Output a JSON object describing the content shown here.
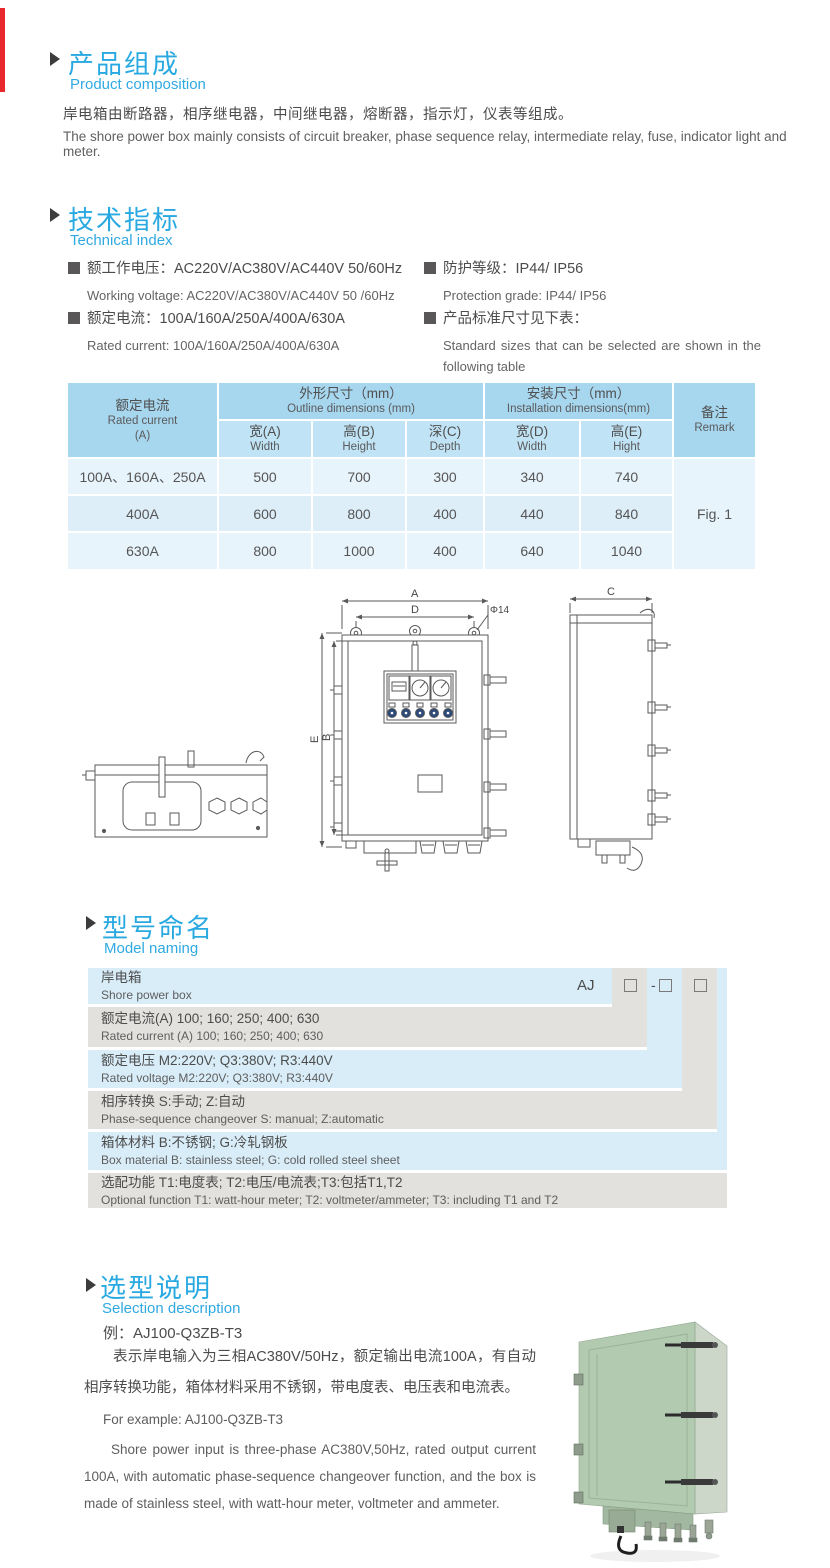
{
  "page": {
    "edge_tab_color": "#e8282d",
    "accent_blue": "#29a9e1"
  },
  "composition": {
    "title_zh": "产品组成",
    "title_en": "Product  composition",
    "body_zh": "岸电箱由断路器，相序继电器，中间继电器，熔断器，指示灯，仪表等组成。",
    "body_en": "The shore power box mainly consists of circuit breaker, phase sequence relay, intermediate relay, fuse, indicator light and meter."
  },
  "technical": {
    "title_zh": "技术指标",
    "title_en": "Technical index",
    "specs": [
      {
        "zh": "额工作电压：AC220V/AC380V/AC440V  50/60Hz",
        "en": "Working voltage: AC220V/AC380V/AC440V 50 /60Hz"
      },
      {
        "zh": "额定电流：100A/160A/250A/400A/630A",
        "en": "Rated current: 100A/160A/250A/400A/630A"
      },
      {
        "zh": "防护等级：IP44/ IP56",
        "en": "Protection grade: IP44/ IP56"
      },
      {
        "zh": "产品标准尺寸见下表：",
        "en": "Standard sizes that can be selected are shown in the following table"
      }
    ]
  },
  "size_table": {
    "rated_zh": "额定电流",
    "rated_en": "Rated current",
    "rated_unit": "(A)",
    "outline_zh": "外形尺寸（mm）",
    "outline_en": "Outline dimensions (mm)",
    "install_zh": "安装尺寸（mm）",
    "install_en": "Installation dimensions(mm)",
    "remark_zh": "备注",
    "remark_en": "Remark",
    "sub": [
      {
        "zh": "宽(A)",
        "en": "Width"
      },
      {
        "zh": "高(B)",
        "en": "Height"
      },
      {
        "zh": "深(C)",
        "en": "Depth"
      },
      {
        "zh": "宽(D)",
        "en": "Width"
      },
      {
        "zh": "高(E)",
        "en": "Hight"
      }
    ],
    "rows": [
      {
        "current": "100A、160A、250A",
        "w": "500",
        "h": "700",
        "d": "300",
        "iw": "340",
        "ih": "740"
      },
      {
        "current": "400A",
        "w": "600",
        "h": "800",
        "d": "400",
        "iw": "440",
        "ih": "840"
      },
      {
        "current": "630A",
        "w": "800",
        "h": "1000",
        "d": "400",
        "iw": "640",
        "ih": "1040"
      }
    ],
    "remark_value": "Fig. 1"
  },
  "drawing": {
    "dim_a": "A",
    "dim_b": "B",
    "dim_c": "C",
    "dim_d": "D",
    "dim_e": "E",
    "hole": "Φ14"
  },
  "model_naming": {
    "title_zh": "型号命名",
    "title_en": "Model naming",
    "prefix": "AJ",
    "dash": "-",
    "box_glyph": "",
    "rows": [
      {
        "zh": "岸电箱",
        "en": "Shore power box"
      },
      {
        "zh": "额定电流(A)  100; 160; 250; 400; 630",
        "en": "Rated current (A) 100; 160; 250; 400; 630"
      },
      {
        "zh": "额定电压   M2:220V;  Q3:380V;  R3:440V",
        "en": "Rated voltage  M2:220V;  Q3:380V;  R3:440V"
      },
      {
        "zh": "相序转换  S:手动; Z:自动",
        "en": "Phase-sequence changeover  S: manual;  Z:automatic"
      },
      {
        "zh": "箱体材料     B:不锈钢;  G:冷轧钢板",
        "en": "Box material   B: stainless steel; G: cold rolled steel sheet"
      },
      {
        "zh": "选配功能      T1:电度表;  T2:电压/电流表;T3:包括T1,T2",
        "en": "Optional function  T1: watt-hour meter; T2: voltmeter/ammeter; T3: including T1 and T2"
      }
    ]
  },
  "selection": {
    "title_zh": "选型说明",
    "title_en": "Selection description",
    "example_zh": "例：AJ100-Q3ZB-T3",
    "body_zh": "表示岸电输入为三相AC380V/50Hz，额定输出电流100A，有自动相序转换功能，箱体材料采用不锈钢，带电度表、电压表和电流表。",
    "example_en": "For example: AJ100-Q3ZB-T3",
    "body_en": "Shore power input is three-phase AC380V,50Hz, rated output current 100A, with automatic phase-sequence changeover function, and the box is made of stainless steel, with watt-hour meter, voltmeter and ammeter."
  }
}
